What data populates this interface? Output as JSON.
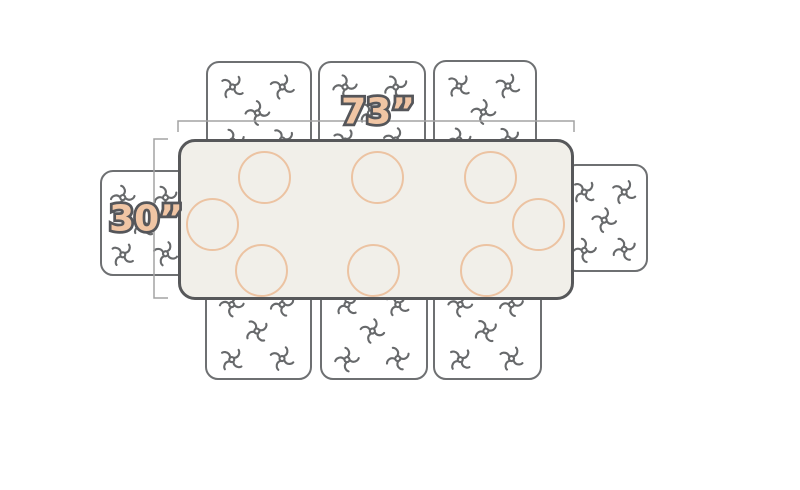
{
  "dimensions": {
    "width": {
      "label": "73”"
    },
    "depth": {
      "label": "30”"
    }
  },
  "colors": {
    "background": "#ffffff",
    "table_fill": "#f1efe9",
    "table_border": "#57585a",
    "chair_fill": "#ffffff",
    "chair_border": "#6e7072",
    "motif": "#67696b",
    "plate": "#ecc3a2",
    "dim_line": "#a3a3a3",
    "label_fill": "#f0c5a4",
    "label_stroke": "#55565a"
  },
  "diagram": {
    "table": {
      "x": 178,
      "y": 139,
      "w": 396,
      "h": 161
    },
    "chairs": [
      {
        "id": "chair-top-1",
        "x": 206,
        "y": 61,
        "w": 106,
        "h": 100
      },
      {
        "id": "chair-top-2",
        "x": 318,
        "y": 61,
        "w": 108,
        "h": 100
      },
      {
        "id": "chair-top-3",
        "x": 433,
        "y": 60,
        "w": 104,
        "h": 100
      },
      {
        "id": "chair-left",
        "x": 100,
        "y": 170,
        "w": 91,
        "h": 106
      },
      {
        "id": "chair-right",
        "x": 563,
        "y": 164,
        "w": 85,
        "h": 108
      },
      {
        "id": "chair-bottom-1",
        "x": 205,
        "y": 278,
        "w": 107,
        "h": 102
      },
      {
        "id": "chair-bottom-2",
        "x": 320,
        "y": 278,
        "w": 108,
        "h": 102
      },
      {
        "id": "chair-bottom-3",
        "x": 433,
        "y": 278,
        "w": 109,
        "h": 102
      }
    ],
    "plates": [
      {
        "cx": 264,
        "cy": 177
      },
      {
        "cx": 377,
        "cy": 177
      },
      {
        "cx": 490,
        "cy": 177
      },
      {
        "cx": 212,
        "cy": 224
      },
      {
        "cx": 538,
        "cy": 224
      },
      {
        "cx": 261,
        "cy": 270
      },
      {
        "cx": 373,
        "cy": 270
      },
      {
        "cx": 486,
        "cy": 270
      }
    ],
    "plate_radius": 26.5,
    "width_dim": {
      "x1": 178,
      "x2": 574,
      "y": 121,
      "tick": 11,
      "label_cx": 378,
      "label_cy": 114
    },
    "depth_dim": {
      "y1": 139,
      "y2": 298,
      "x": 154,
      "tick": 14,
      "label_cx": 146,
      "label_cy": 221
    }
  }
}
